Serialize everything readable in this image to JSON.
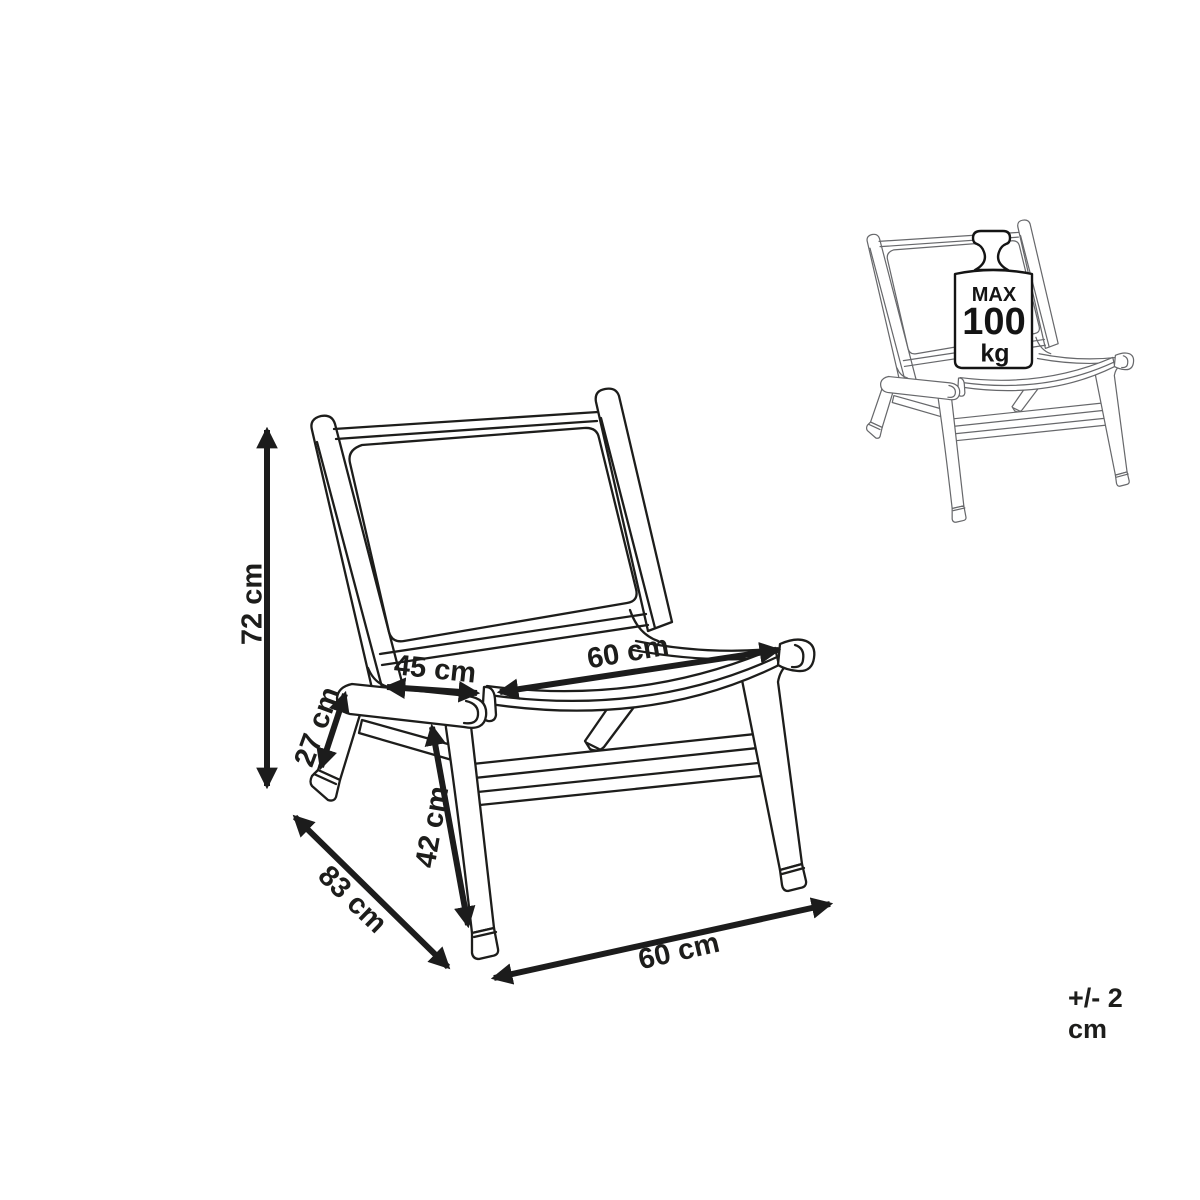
{
  "diagram": {
    "type": "furniture-dimension-diagram",
    "subject": "wooden lounge chair line drawing with dimension arrows",
    "dimensions": {
      "back_height": "72 cm",
      "seat_depth_front": "45 cm",
      "seat_width": "60 cm",
      "armrest_front_height": "27 cm",
      "seat_height": "42 cm",
      "total_depth": "83 cm",
      "total_width": "60 cm"
    },
    "max_load": {
      "prefix": "MAX",
      "value": "100",
      "unit": "kg"
    },
    "tolerance": "+/- 2 cm",
    "colors": {
      "main_line": "#1d1d1b",
      "thumbnail_line": "#67686b",
      "arrow": "#1c1c1c",
      "background": "#ffffff"
    },
    "icons": [
      "max-weight-icon"
    ]
  }
}
